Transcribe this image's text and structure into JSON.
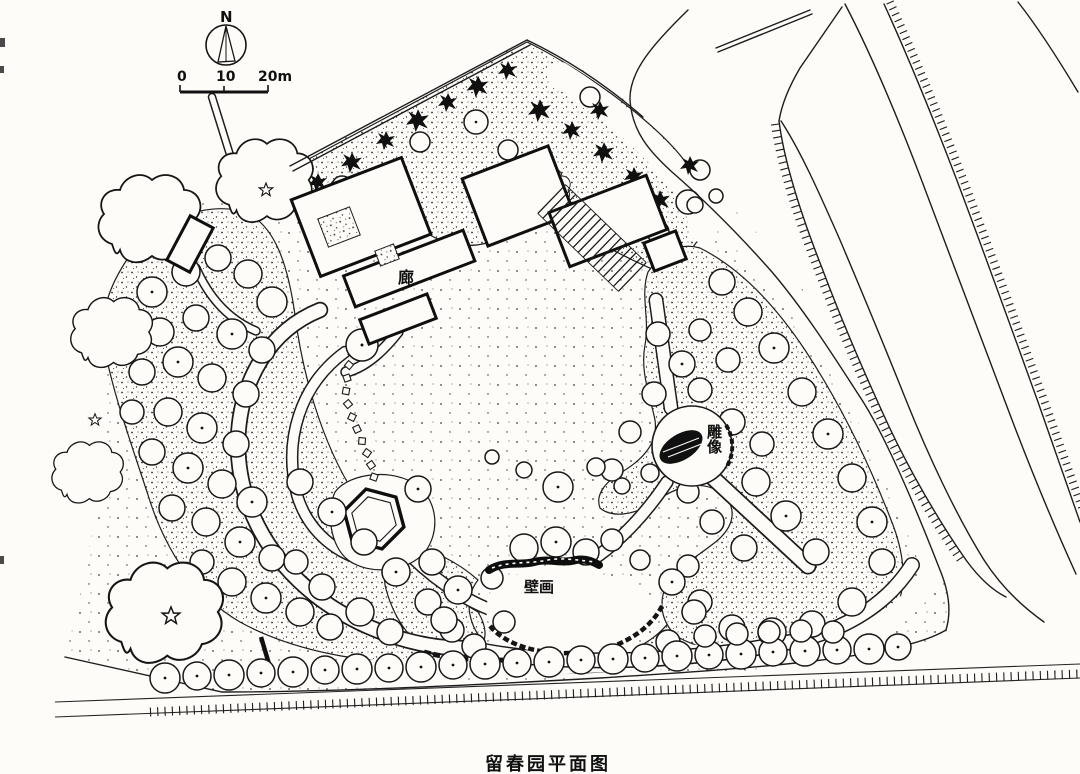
{
  "title": "留春园平面图",
  "compass": {
    "north": "N"
  },
  "scale_bar": {
    "t0": "0",
    "t1": "10",
    "t2": "20m"
  },
  "labels": {
    "corridor": "廊",
    "statue": "雕像",
    "mural": "壁画"
  }
}
